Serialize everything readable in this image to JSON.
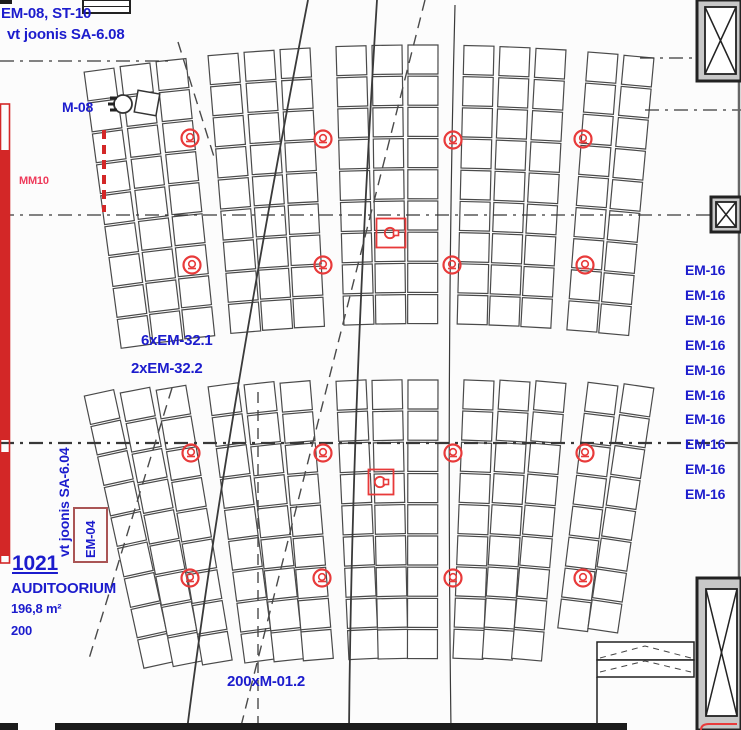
{
  "document": {
    "type": "auditorium-ceiling-plan",
    "language": "Estonian"
  },
  "room": {
    "number": "1021",
    "name": "AUDITOORIUM",
    "area": "196,8 m²",
    "capacity": "200"
  },
  "annotations": [
    {
      "id": "em08-st10",
      "text": "EM-08, ST-10",
      "x": 1,
      "y": 6,
      "size": 15
    },
    {
      "id": "vt-joonis-sa608",
      "text": "vt joonis SA-6.08",
      "x": 7,
      "y": 27,
      "size": 15
    },
    {
      "id": "m08",
      "text": "M-08",
      "x": 62,
      "y": 100,
      "size": 14
    },
    {
      "id": "mm10",
      "text": "MM10",
      "x": 19,
      "y": 176,
      "size": 11,
      "color": "#ee3a5a"
    },
    {
      "id": "em32-1",
      "text": "6xEM-32.1",
      "x": 141,
      "y": 333,
      "size": 15
    },
    {
      "id": "em32-2",
      "text": "2xEM-32.2",
      "x": 131,
      "y": 361,
      "size": 15
    },
    {
      "id": "vt-joonis-sa604",
      "text": "vt joonis SA-6.04",
      "x": 57,
      "y": 557,
      "size": 14,
      "rot": -90
    },
    {
      "id": "em04",
      "text": "EM-04",
      "x": 84,
      "y": 558,
      "size": 13,
      "rot": -90
    },
    {
      "id": "m012",
      "text": "200xM-01.2",
      "x": 227,
      "y": 674,
      "size": 15
    }
  ],
  "em16_list": [
    "EM-16",
    "EM-16",
    "EM-16",
    "EM-16",
    "EM-16",
    "EM-16",
    "EM-16",
    "EM-16",
    "EM-16",
    "EM-16"
  ],
  "em16_layout": {
    "x": 685,
    "top0": 263,
    "step": 24.9,
    "size": 14
  },
  "colors": {
    "annotation_blue": "#1c1ccd",
    "symbol_red": "#e83a3a",
    "mm10_red": "#ee3a5a",
    "bar_red": "#d32727",
    "em04_box_red": "#aa5555",
    "seat_stroke": "#4a4a4a",
    "wall_dark": "#1b1b1b",
    "column_fill": "#c8c8c8"
  },
  "drawing": {
    "strips": {
      "lefts": [
        84,
        120,
        156,
        208,
        244,
        280,
        336,
        372,
        408,
        464,
        500,
        536,
        588,
        624
      ],
      "width": 30,
      "box_h": 29,
      "pitch": 31.2,
      "apex_x": 420,
      "bands": [
        {
          "top": 45,
          "sag_k": 4100,
          "tilt_div": 42,
          "rows": 9,
          "overrides": {}
        },
        {
          "top": 380,
          "sag_k": 8000,
          "tilt_div": 26,
          "rows": 9,
          "overrides": {
            "588": 8,
            "624": 8
          }
        }
      ]
    },
    "detectors": [
      [
        190,
        138
      ],
      [
        323,
        139
      ],
      [
        453,
        140
      ],
      [
        583,
        139
      ],
      [
        192,
        265
      ],
      [
        323,
        265
      ],
      [
        452,
        265
      ],
      [
        585,
        265
      ],
      [
        191,
        453
      ],
      [
        323,
        453
      ],
      [
        453,
        453
      ],
      [
        585,
        453
      ],
      [
        190,
        578
      ],
      [
        322,
        578
      ],
      [
        453,
        578
      ],
      [
        583,
        578
      ]
    ],
    "fixture_boxes": [
      {
        "cx": 391,
        "cy": 233,
        "size": 29
      },
      {
        "cx": 381,
        "cy": 482,
        "size": 25
      }
    ],
    "centerlines": [
      {
        "x1": 0,
        "y1": 61,
        "x2": 170,
        "y2": 61,
        "w": 1.3
      },
      {
        "x1": 640,
        "y1": 58,
        "x2": 741,
        "y2": 58,
        "w": 1.3
      },
      {
        "x1": 645,
        "y1": 110,
        "x2": 741,
        "y2": 110,
        "w": 1.3
      },
      {
        "x1": 0,
        "y1": 215,
        "x2": 712,
        "y2": 215,
        "w": 1.3
      },
      {
        "x1": 0,
        "y1": 443,
        "x2": 741,
        "y2": 443,
        "w": 2.2
      }
    ],
    "dash_lines": [
      {
        "x1": 425,
        "y1": 0,
        "x2": 240,
        "y2": 730
      },
      {
        "x1": 258,
        "y1": 392,
        "x2": 258,
        "y2": 728
      },
      {
        "x1": 172,
        "y1": 388,
        "x2": 88,
        "y2": 662
      },
      {
        "x1": 178,
        "y1": 42,
        "x2": 215,
        "y2": 160
      }
    ],
    "curves": [
      {
        "d": "M308,0 Q225,430 187,730",
        "w": 1.8
      },
      {
        "d": "M377,0 Q352,400 349,730",
        "w": 1.8
      },
      {
        "d": "M455,5 Q446,350 451,730",
        "w": 1.2
      }
    ],
    "red_bar": {
      "outline": {
        "x": 0.5,
        "y": 104,
        "w": 9,
        "h": 459
      },
      "fills": [
        {
          "x": 1,
          "y": 150,
          "w": 8,
          "h": 290
        },
        {
          "x": 1,
          "y": 452,
          "w": 8,
          "h": 104
        }
      ],
      "dash_line": {
        "x": 104,
        "y1": 130,
        "y2": 212
      }
    },
    "em04_box": {
      "x": 74,
      "y": 508,
      "w": 33,
      "h": 54
    },
    "walls": {
      "corner_mark": {
        "x": 0,
        "y": 0,
        "w": 12,
        "h": 4
      },
      "topleft_box": {
        "x": 83,
        "y": 0,
        "w": 47,
        "h": 13
      },
      "bottom_bar": {
        "x": 55,
        "y": 723,
        "w": 572,
        "h": 7
      },
      "bottom_left": {
        "x": 0,
        "y": 723,
        "w": 18,
        "h": 7
      },
      "right_edge": {
        "x": 739,
        "y1": 80,
        "y2": 578
      },
      "columns": [
        {
          "ox": 697,
          "oy": 0,
          "ow": 44,
          "oh": 81,
          "ix": 705,
          "iy": 7,
          "iw": 31,
          "ih": 67
        },
        {
          "ox": 711,
          "oy": 197,
          "ow": 30,
          "oh": 35,
          "ix": 716,
          "iy": 202,
          "iw": 20,
          "ih": 25
        },
        {
          "ox": 697,
          "oy": 578,
          "ow": 44,
          "oh": 152,
          "ix": 706,
          "iy": 589,
          "iw": 31,
          "ih": 127
        }
      ],
      "door": {
        "r1": {
          "x": 597,
          "y": 642,
          "w": 97,
          "h": 18
        },
        "r2": {
          "x": 597,
          "y": 660,
          "w": 97,
          "h": 17
        },
        "chevron1": "M600,658 L645,646 L691,658",
        "chevron2": "M600,672 L645,661 L691,672",
        "jamb": {
          "x": 597,
          "y1": 677,
          "y2": 724
        }
      },
      "red_corner": "M701,730 Q701,724 709,724 L737,724"
    },
    "m08_fixture": {
      "circle": {
        "cx": 123,
        "cy": 104,
        "r": 9
      },
      "rect": {
        "x": 136,
        "y": 92,
        "w": 22,
        "h": 22,
        "rot": 10
      }
    }
  }
}
